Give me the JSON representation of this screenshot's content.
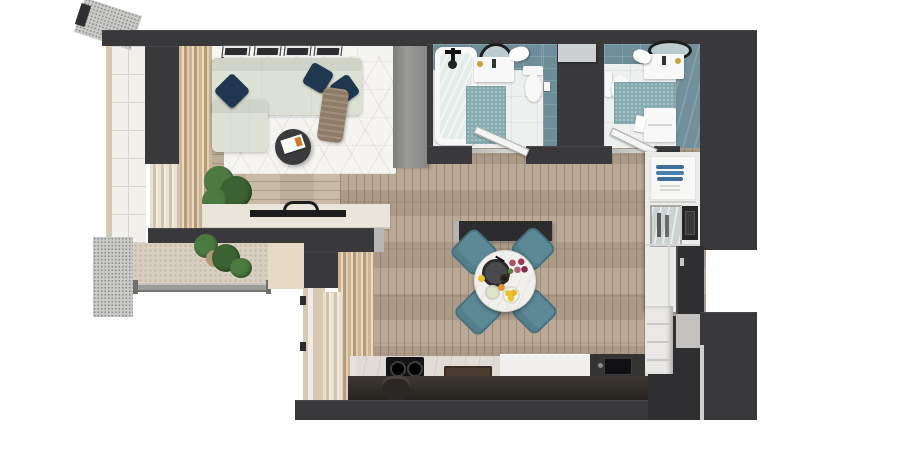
{
  "scene": {
    "type": "architectural-floor-plan-3d-render",
    "view": "top-down",
    "background": "white",
    "description": "Top-down 3D render of a small apartment: living room with corner sofa top-left, balcony with plants along the left, two teal-tiled bathrooms at top, open dining area with round table and four teal chairs in the center, kitchen counters along the bottom and right, entrance door in a recess on the right wall."
  },
  "colors": {
    "wall": "#39393b",
    "wallDeep": "#2f2f31",
    "woodMain": "#b6a491",
    "woodLight": "#c7b6a3",
    "rug": "#f5f4f0",
    "sofa": "#dde1d5",
    "pillow": "#1f3850",
    "blanket": "#8e7c68",
    "tableDark": "#3a3a3c",
    "consoleTop": "#eae5da",
    "wardrobe": "#8f8f8d",
    "balconyTile": "#f1f0ec",
    "tileLine": "#d9d6d0",
    "mesh": "#c9c9c7",
    "meshDot": "#8b8b89",
    "woven": "#d8cfc0",
    "sill": "#e4dac6",
    "frame": "#d6c8b1",
    "tealWall": "#6d8d99",
    "tealMat": "#87adb1",
    "bathFloor": "#eef0f0",
    "fixtureWhite": "#f7f8f7",
    "chairTeal": "#5d8997",
    "chairTealDark": "#48707e",
    "tableWhite": "#f2f0ed",
    "marble": "#e0dcd5",
    "counterWhite": "#f1f0ee",
    "counterDark": "#343432",
    "cabinetDeep": "#211e1b",
    "cooktop": "#141416",
    "glassCab": "#ccd1d2",
    "blueDish": "#3e6f9d",
    "oven": "#262626",
    "entryDoor": "#2f2f31",
    "metal": "#c9c9c7",
    "plant": "#4c7a40",
    "plantDark": "#3c6132",
    "lemon": "#ecc32f",
    "flower": "#9c3a55",
    "doorLeaf": "#f4f4f2"
  },
  "rooms": [
    {
      "name": "living-room",
      "position": "top-left",
      "furniture": [
        "corner-sofa",
        "navy-pillows-x3",
        "throw-blanket",
        "round-coffee-table",
        "magazines",
        "geometric-rug",
        "picture-frames-x4",
        "media-console",
        "tv",
        "potted-plant",
        "wardrobe",
        "wall-unit"
      ]
    },
    {
      "name": "balcony",
      "position": "left",
      "furniture": [
        "tiled-floor",
        "mesh-railing",
        "awning",
        "curtains",
        "planters-x2",
        "glass-balustrade",
        "window-wall"
      ]
    },
    {
      "name": "bathroom-1",
      "position": "top-center",
      "furniture": [
        "bathtub",
        "shower-fixture",
        "round-mirror",
        "vanity-sink",
        "toilet",
        "teal-bath-mat",
        "towel",
        "wall-cabinet",
        "door-open"
      ]
    },
    {
      "name": "bathroom-2",
      "position": "top-right",
      "furniture": [
        "oval-mirror",
        "vanity-sink",
        "toilet",
        "teal-bath-mat",
        "washing-machine",
        "towel",
        "door-open"
      ]
    },
    {
      "name": "dining-area",
      "position": "center",
      "furniture": [
        "round-marble-table",
        "teal-chairs-x4",
        "dinner-plate",
        "coffee-cup",
        "flower-bouquet",
        "fruit-bowl-lemons",
        "juice-glass",
        "partition-wall"
      ]
    },
    {
      "name": "kitchen",
      "position": "bottom",
      "furniture": [
        "cooktop-2-burners",
        "marble-counter",
        "white-counter",
        "dark-counter-with-sink",
        "serving-tray",
        "bar-stool",
        "tall-cabinet-open-shelves",
        "blue-dishes",
        "glass-display-cabinet",
        "built-in-oven",
        "drawer-unit"
      ]
    },
    {
      "name": "entrance",
      "position": "right",
      "furniture": [
        "entry-door",
        "door-handle",
        "entry-floor"
      ]
    }
  ]
}
